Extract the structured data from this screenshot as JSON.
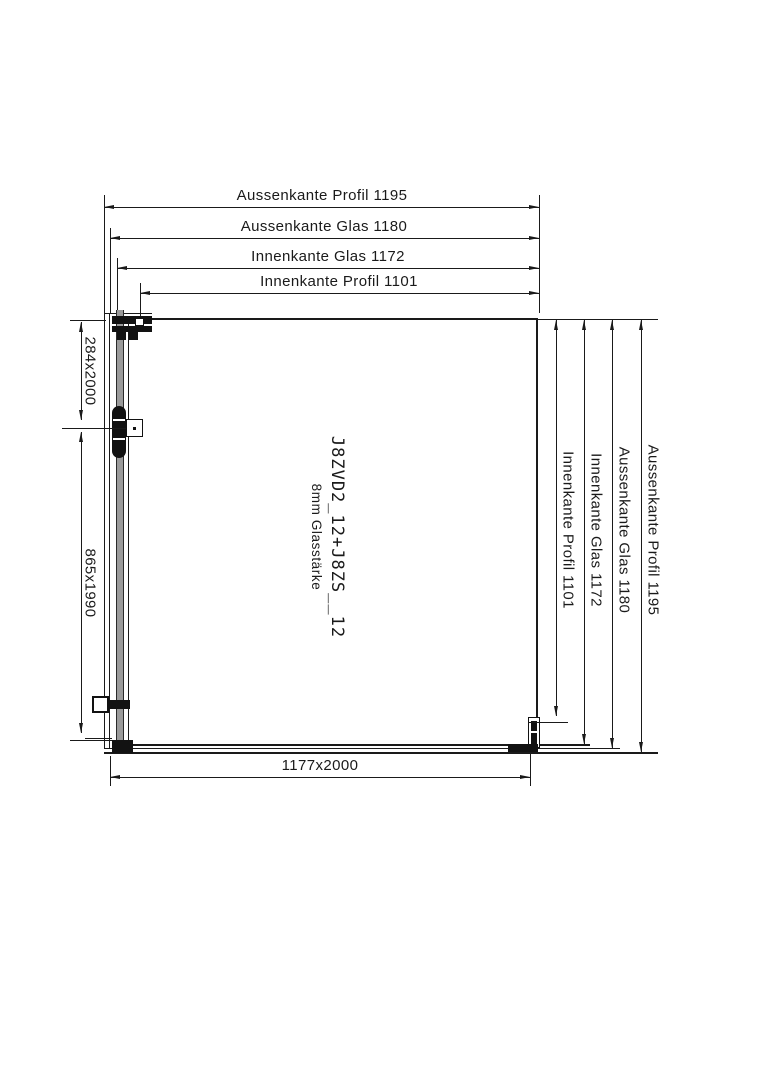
{
  "drawing": {
    "top_dims": [
      "Aussenkante Profil 1195",
      "Aussenkante Glas 1180",
      "Innenkante Glas 1172",
      "Innenkante Profil 1101"
    ],
    "right_dims": [
      "Innenkante Profil 1101",
      "Innenkante Glas 1172",
      "Aussenkante Glas 1180",
      "Aussenkante Profil 1195"
    ],
    "left_dims": [
      "284x2000",
      "865x1990"
    ],
    "bottom_dim": "1177x2000",
    "product_code": "J8ZVD2_12+J8ZS__12",
    "glass_note": "8mm Glasstärke",
    "colors": {
      "line": "#1a1a1a",
      "glass_edge": "#9b9b9b",
      "fill": "#121212"
    }
  }
}
